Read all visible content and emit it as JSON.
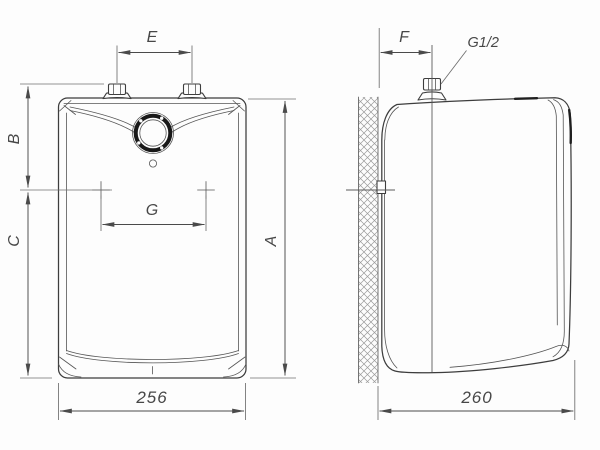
{
  "drawing": {
    "type": "technical-dimension-drawing",
    "subject": "wall-mounted water heater, front and side orthographic views",
    "colors": {
      "background": "#fdfdfd",
      "line": "#3d3d3d",
      "dimension": "#4a4a4a",
      "knob_ring": "#181818",
      "wall_hatch": "#9a9a9a"
    },
    "front_view": {
      "name": "front view",
      "width_value": "256",
      "dims": {
        "e": "E",
        "b": "B",
        "c": "C",
        "g": "G",
        "a": "A"
      }
    },
    "side_view": {
      "name": "side view",
      "depth_value": "260",
      "dims": {
        "f": "F"
      },
      "thread_label": "G1/2"
    }
  }
}
